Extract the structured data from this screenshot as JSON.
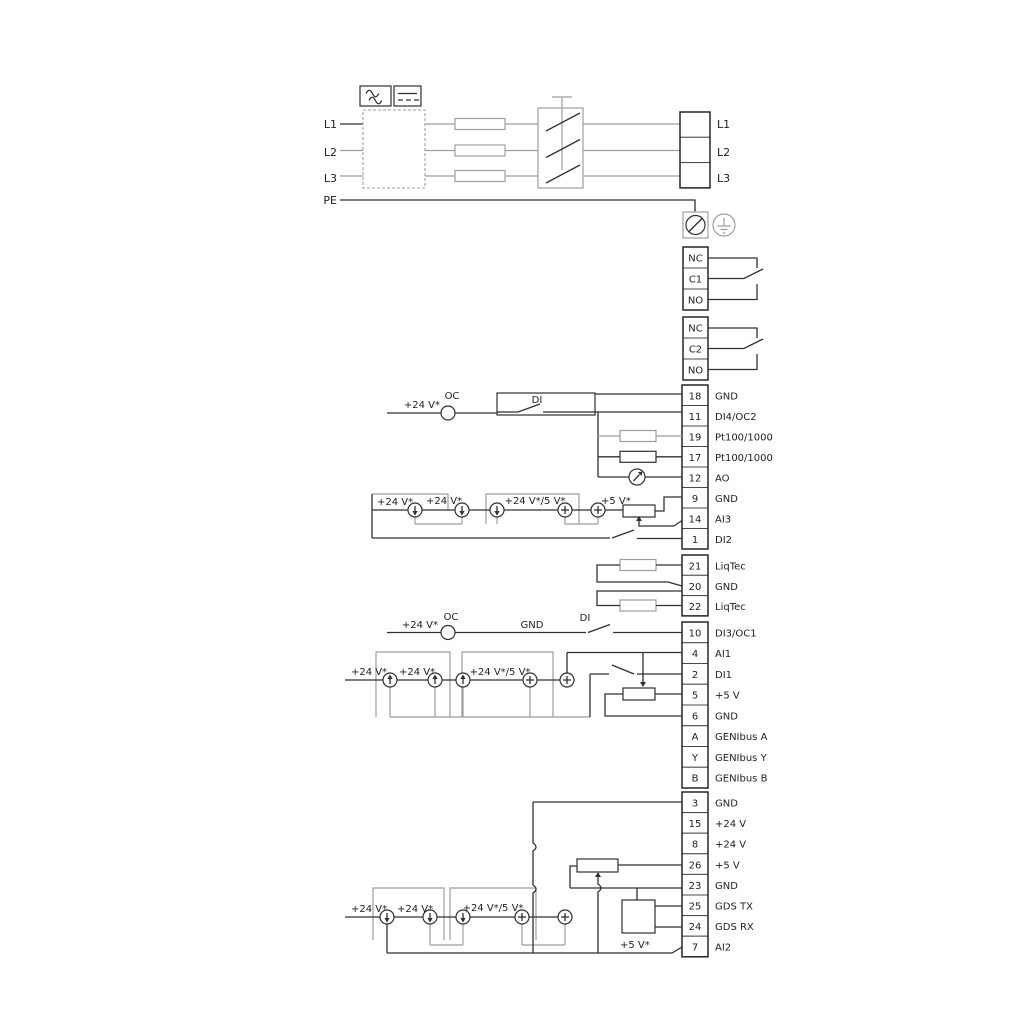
{
  "colors": {
    "wire": "#303030",
    "wire_alt": "#9e9e9e",
    "background": "#ffffff"
  },
  "power": {
    "inputs": [
      {
        "label": "L1"
      },
      {
        "label": "L2"
      },
      {
        "label": "L3"
      },
      {
        "label": "PE"
      }
    ],
    "outputs": [
      {
        "label": "L1"
      },
      {
        "label": "L2"
      },
      {
        "label": "L3"
      }
    ]
  },
  "relays": {
    "relay1": {
      "rows": [
        {
          "label": "NC"
        },
        {
          "label": "C1"
        },
        {
          "label": "NO"
        }
      ]
    },
    "relay2": {
      "rows": [
        {
          "label": "NC"
        },
        {
          "label": "C2"
        },
        {
          "label": "NO"
        }
      ]
    }
  },
  "strip1": {
    "rows": [
      {
        "num": "18",
        "label": "GND"
      },
      {
        "num": "11",
        "label": "DI4/OC2"
      },
      {
        "num": "19",
        "label": "Pt100/1000"
      },
      {
        "num": "17",
        "label": "Pt100/1000"
      },
      {
        "num": "12",
        "label": "AO"
      },
      {
        "num": "9",
        "label": "GND"
      },
      {
        "num": "14",
        "label": "AI3"
      },
      {
        "num": "1",
        "label": "DI2"
      }
    ]
  },
  "liqtec": {
    "rows": [
      {
        "num": "21",
        "label": "LiqTec"
      },
      {
        "num": "20",
        "label": "GND"
      },
      {
        "num": "22",
        "label": "LiqTec"
      }
    ]
  },
  "strip2": {
    "rows": [
      {
        "num": "10",
        "label": "DI3/OC1"
      },
      {
        "num": "4",
        "label": "AI1"
      },
      {
        "num": "2",
        "label": "DI1"
      },
      {
        "num": "5",
        "label": "+5 V"
      },
      {
        "num": "6",
        "label": "GND"
      },
      {
        "num": "A",
        "label": "GENIbus A"
      },
      {
        "num": "Y",
        "label": "GENIbus Y"
      },
      {
        "num": "B",
        "label": "GENIbus B"
      }
    ]
  },
  "strip3": {
    "rows": [
      {
        "num": "3",
        "label": "GND"
      },
      {
        "num": "15",
        "label": "+24 V"
      },
      {
        "num": "8",
        "label": "+24 V"
      },
      {
        "num": "26",
        "label": "+5 V"
      },
      {
        "num": "23",
        "label": "GND"
      },
      {
        "num": "25",
        "label": "GDS TX"
      },
      {
        "num": "24",
        "label": "GDS RX"
      },
      {
        "num": "7",
        "label": "AI2"
      }
    ]
  },
  "ann": {
    "oc_top": {
      "supply": "+24 V*",
      "oc": "OC",
      "di": "DI"
    },
    "row1": {
      "s1": "+24 V*",
      "s2": "+24 V*",
      "s3": "+24 V*/5 V*",
      "s4": "+5 V*"
    },
    "oc_mid": {
      "supply": "+24 V*",
      "oc": "OC",
      "gnd": "GND",
      "di": "DI"
    },
    "row2": {
      "s1": "+24 V*",
      "s2": "+24 V*",
      "s3": "+24 V*/5 V*"
    },
    "row3": {
      "s1": "+24 V*",
      "s2": "+24 V*",
      "s3": "+24 V*/5 V*",
      "s4": "+5 V*"
    }
  }
}
